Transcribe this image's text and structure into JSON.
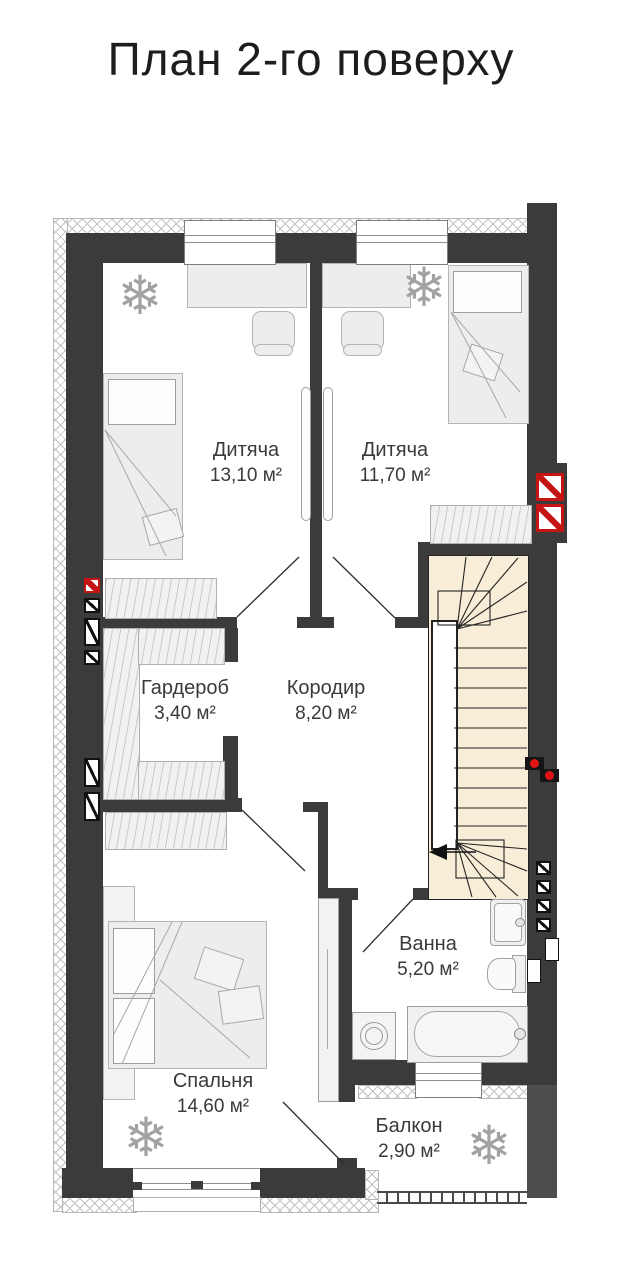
{
  "title": "План 2-го поверху",
  "rooms": [
    {
      "name": "Дитяча",
      "area": "13,10 м²"
    },
    {
      "name": "Дитяча",
      "area": "11,70 м²"
    },
    {
      "name": "Гардероб",
      "area": "3,40 м²"
    },
    {
      "name": "Кородир",
      "area": "8,20 м²"
    },
    {
      "name": "Ванна",
      "area": "5,20 м²"
    },
    {
      "name": "Спальня",
      "area": "14,60 м²"
    },
    {
      "name": "Балкон",
      "area": "2,90 м²"
    }
  ],
  "icons": {
    "plant": "❄"
  },
  "colors": {
    "wall": "#3b3b3b",
    "wall_light": "#4d4d4d",
    "stairs_fill": "#f8eed7",
    "vent_red": "#c41414",
    "furniture_fill": "#ededed",
    "hatch_line": "#c2c2c2"
  }
}
